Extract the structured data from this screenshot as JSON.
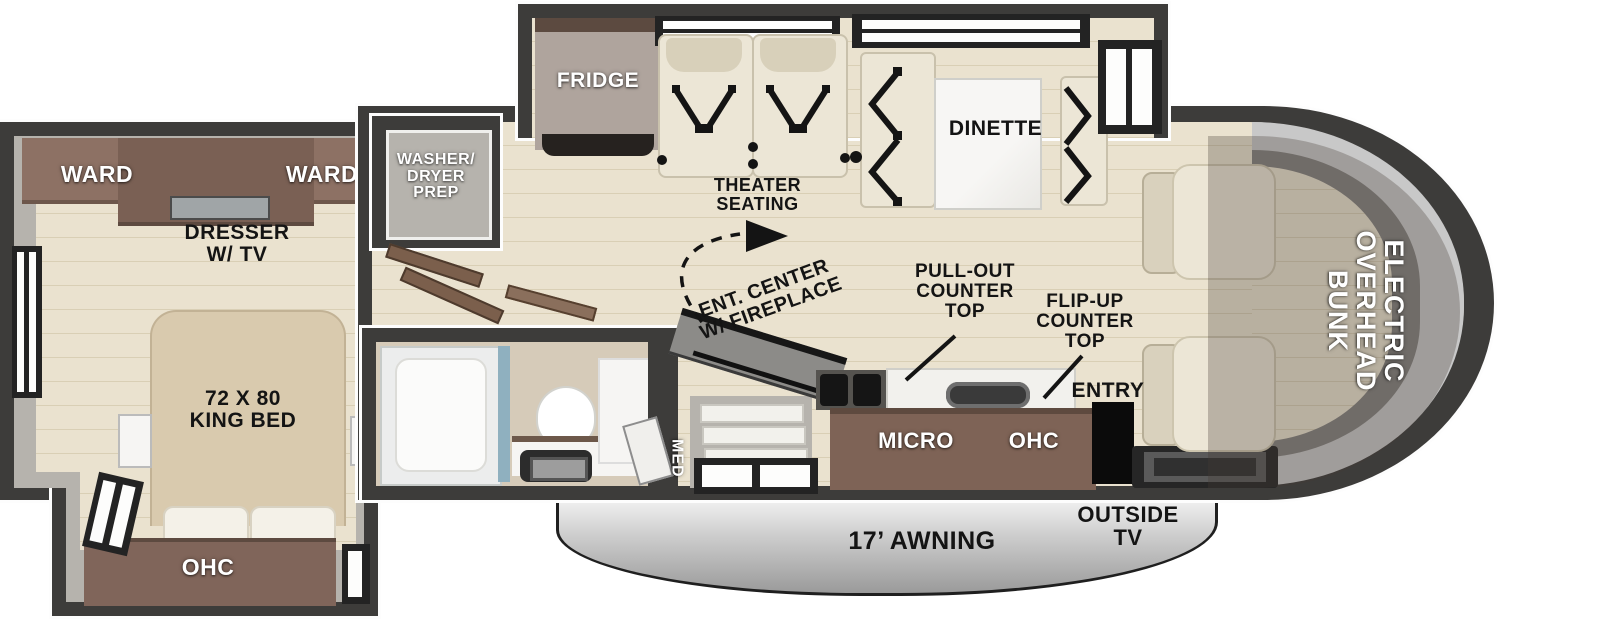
{
  "title": "RV floorplan with electric overhead bunk",
  "palette": {
    "wall": "#3d3c3a",
    "floor": "#eae2cf",
    "floor-stripe": "#d9cfb5",
    "slide-gray": "#b6b3ad",
    "cabinet": "#7e6356",
    "cabinet-dark": "#5e4a3f",
    "ward": "#8d7164",
    "bed": "#d9caae",
    "seat": "#ece6d6",
    "seat-trim": "#c9c1ac",
    "marble": "#f6f5f3",
    "glass": "#c8c8c8",
    "label-dark": "#141414",
    "label-light": "#ffffff",
    "window": "#232323",
    "shower-glass": "#8fb0bf"
  },
  "labels": {
    "ward_left": "WARD",
    "ward_right": "WARD",
    "dresser": "DRESSER\nW/ TV",
    "king_bed": "72 X 80\nKING BED",
    "ohc_bedroom": "OHC",
    "washer_dryer": "WASHER/\nDRYER\nPREP",
    "fridge": "FRIDGE",
    "theater_seating": "THEATER\nSEATING",
    "dinette": "DINETTE",
    "ent_center": "ENT. CENTER\nW/ FIREPLACE",
    "pull_out_counter": "PULL-OUT\nCOUNTER\nTOP",
    "flip_up_counter": "FLIP-UP\nCOUNTER\nTOP",
    "entry": "ENTRY",
    "micro": "MICRO",
    "ohc_kitchen": "OHC",
    "med": "MED",
    "awning": "17’ AWNING",
    "outside_tv": "OUTSIDE\nTV",
    "overhead_bunk": "ELECTRIC\nOVERHEAD\nBUNK"
  }
}
